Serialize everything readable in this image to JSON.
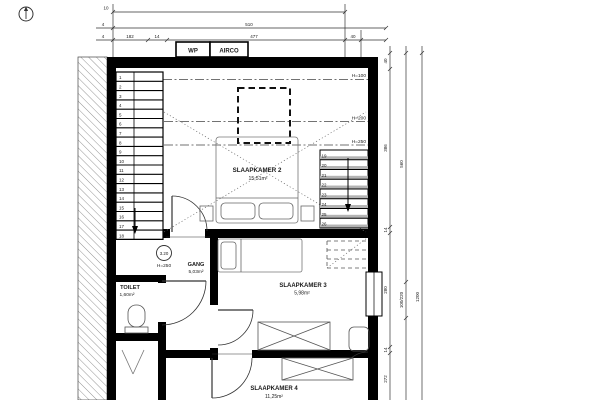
{
  "drawing": {
    "type": "floor-plan"
  },
  "top_dims": {
    "row1": "10",
    "row2_small": "4",
    "row2_total": "510",
    "row3_small": "4",
    "row3": [
      "182",
      "14",
      "477",
      "40"
    ],
    "boxes": [
      "WP",
      "AIRCO"
    ]
  },
  "rooms": {
    "slaapkamer2": {
      "name": "SLAAPKAMER 2",
      "area": "15,51m²"
    },
    "gang": {
      "name": "GANG",
      "area": "5,03m²"
    },
    "toilet": {
      "name": "TOILET",
      "area": "1,60m²"
    },
    "slaapkamer3": {
      "name": "SLAAPKAMER 3",
      "area": "5,98m²"
    },
    "slaapkamer4": {
      "name": "SLAAPKAMER 4",
      "area": "11,25m²"
    }
  },
  "level_marker": {
    "value": "3.20",
    "height": "H=250"
  },
  "height_labels": [
    "H=100",
    "H=200",
    "H=250"
  ],
  "stairs": {
    "left_numbers": [
      "1",
      "2",
      "3",
      "4",
      "5",
      "6",
      "7",
      "8",
      "9",
      "10",
      "11",
      "12",
      "13",
      "14",
      "15",
      "16",
      "17",
      "18"
    ],
    "right_numbers": [
      "19",
      "20",
      "21",
      "22",
      "23",
      "24",
      "25",
      "26"
    ]
  },
  "right_dims": {
    "col_a": [
      "40",
      "386",
      "14",
      "280",
      "14",
      "272"
    ],
    "col_b": [
      "560",
      "100/220"
    ],
    "col_c": [
      "1200"
    ]
  },
  "colors": {
    "wall": "#000000",
    "line": "#1a1a1a",
    "hatch": "#8a8a8a",
    "shade": "#b3b3b3"
  }
}
